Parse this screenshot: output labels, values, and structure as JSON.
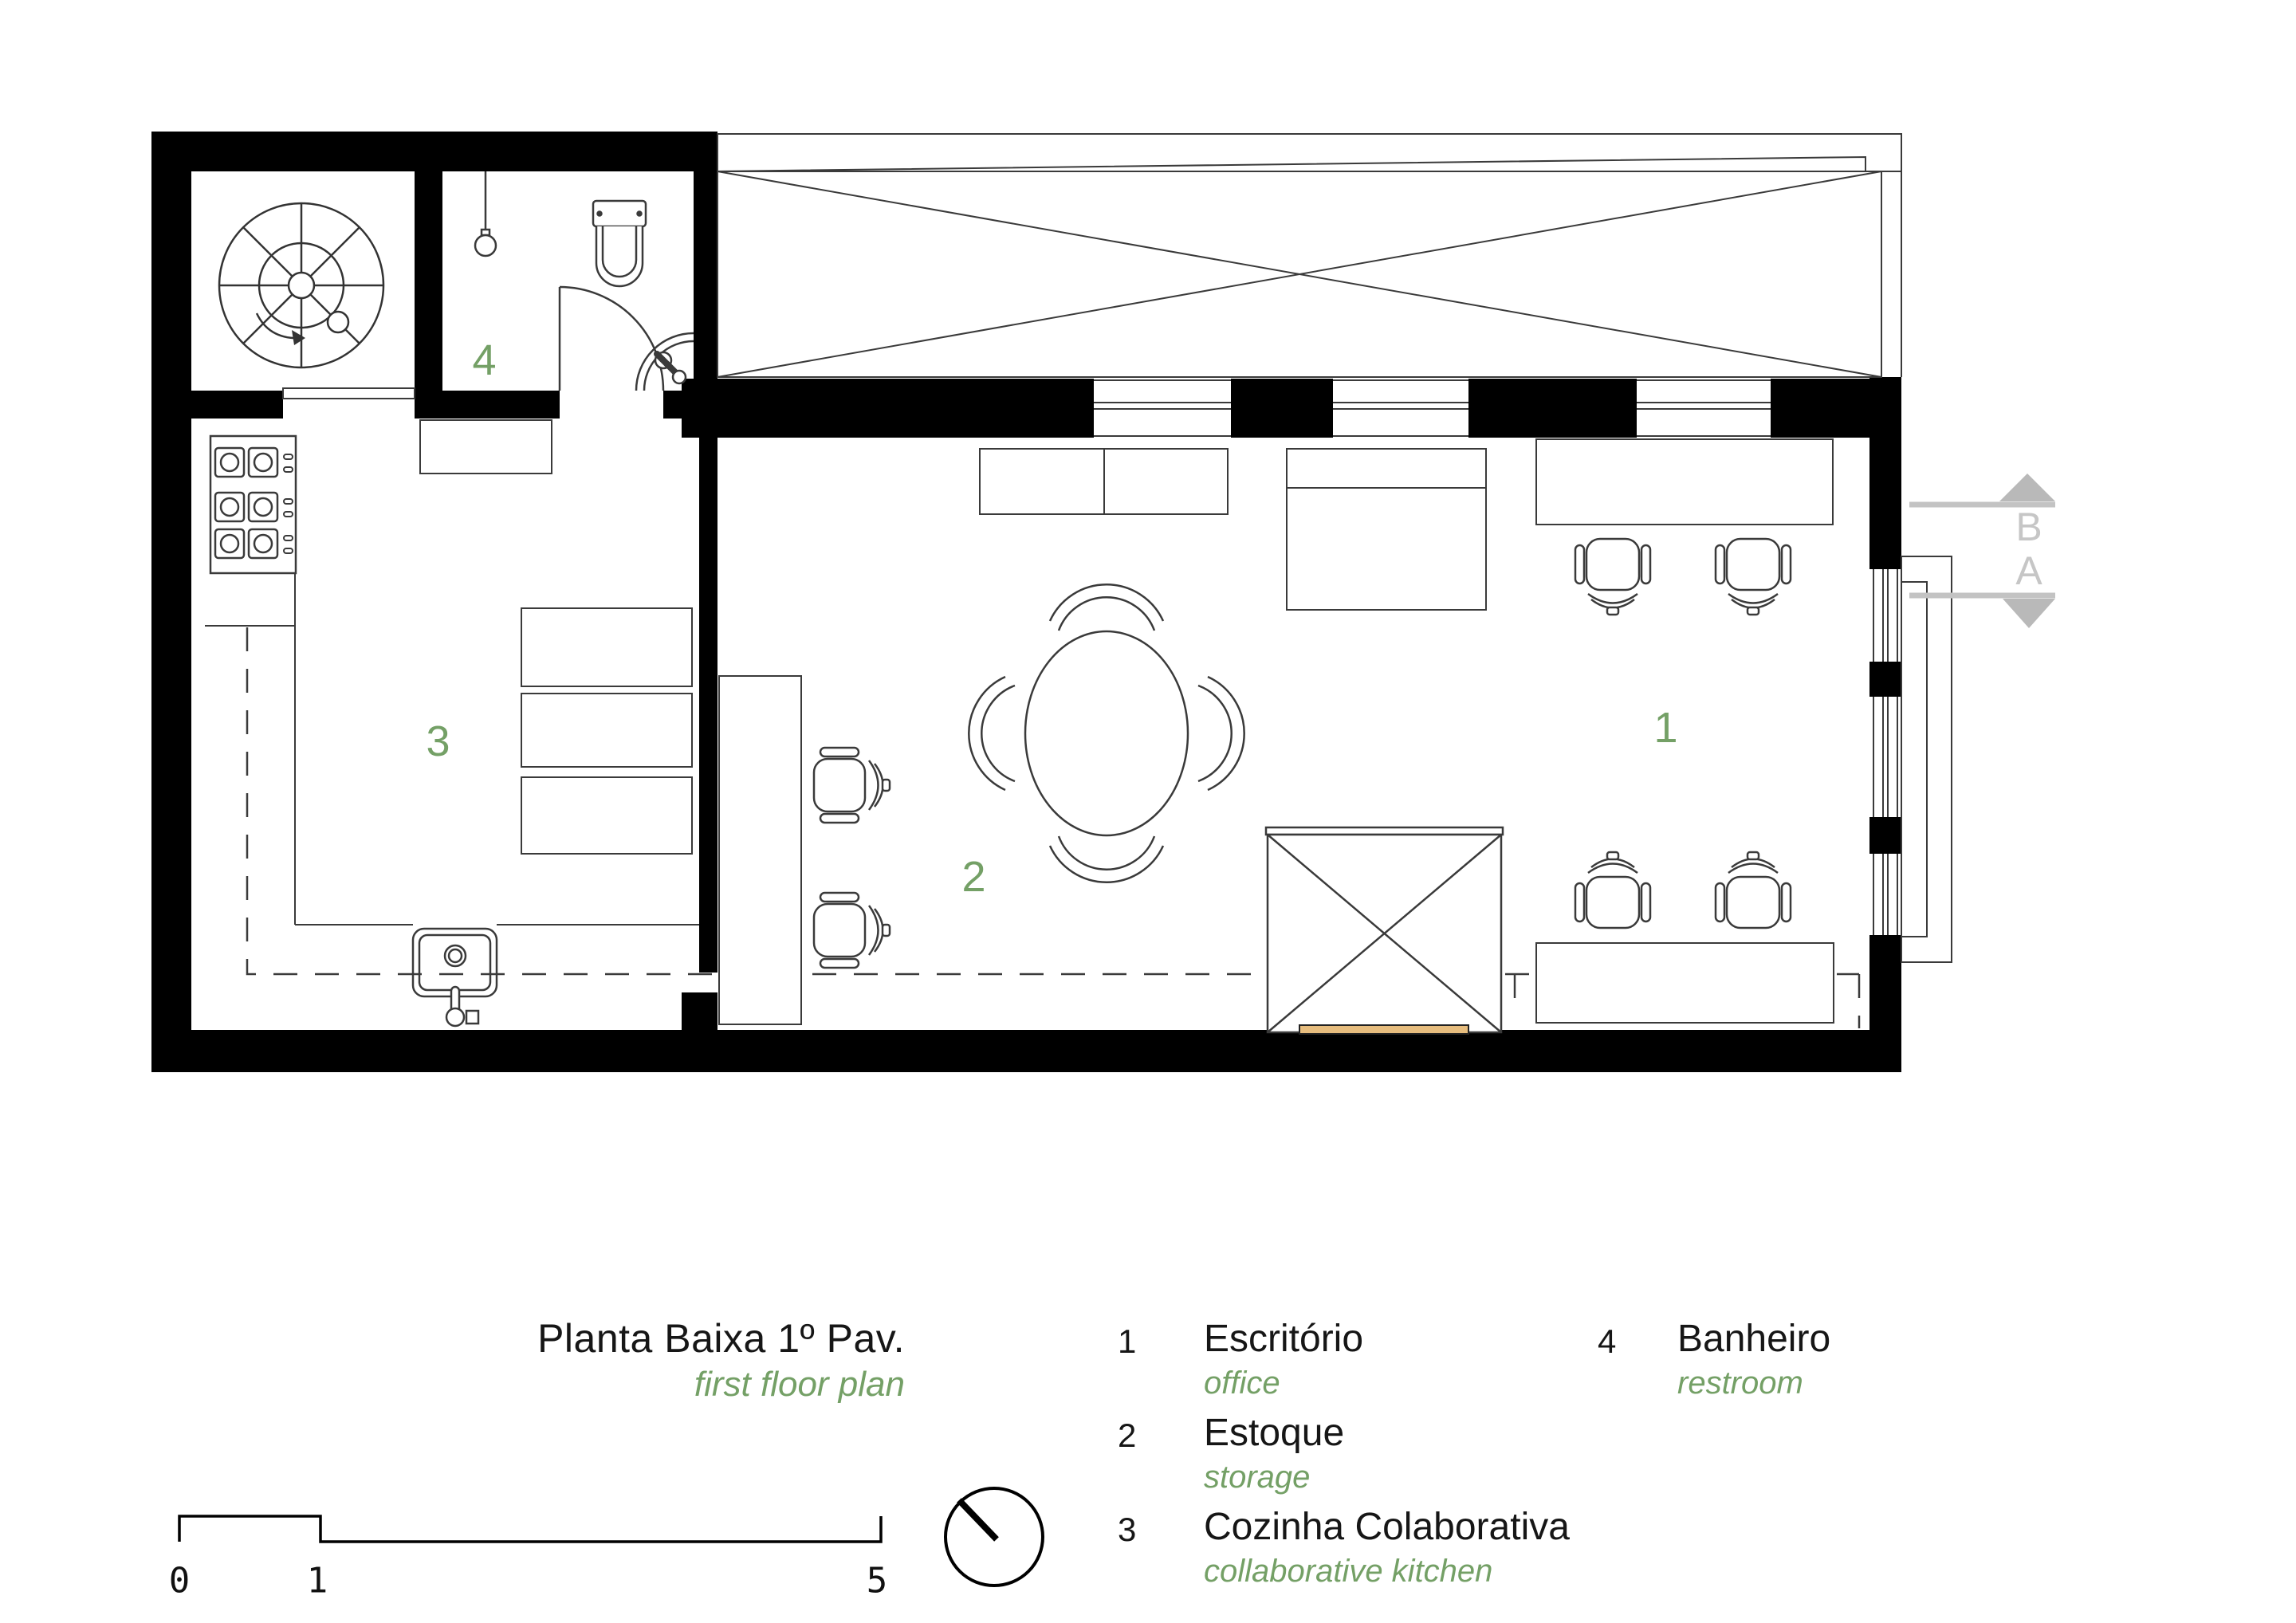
{
  "title_block": {
    "title": "Planta Baixa 1º Pav.",
    "subtitle": "first floor plan"
  },
  "plan": {
    "room_labels": [
      {
        "id": "office",
        "number": "1"
      },
      {
        "id": "storage",
        "number": "2"
      },
      {
        "id": "collaborative-kitchen",
        "number": "3"
      },
      {
        "id": "restroom",
        "number": "4"
      }
    ],
    "section_markers": {
      "top": "B",
      "bottom": "A"
    }
  },
  "legend": {
    "items": [
      {
        "number": "1",
        "name": "Escritório",
        "translation": "office"
      },
      {
        "number": "2",
        "name": "Estoque",
        "translation": "storage"
      },
      {
        "number": "3",
        "name": "Cozinha Colaborativa",
        "translation": "collaborative kitchen"
      },
      {
        "number": "4",
        "name": "Banheiro",
        "translation": "restroom"
      }
    ]
  },
  "scale_bar": {
    "start": "0",
    "mid": "1",
    "end": "5"
  },
  "colors": {
    "accent_green": "#74a066",
    "marker_gray": "#c6c6c6",
    "marker_triangle_gray": "#b9b9b9",
    "wall_black": "#000000",
    "line_gray": "#3a3a3a",
    "wood_bar": "#e7bd7e"
  }
}
